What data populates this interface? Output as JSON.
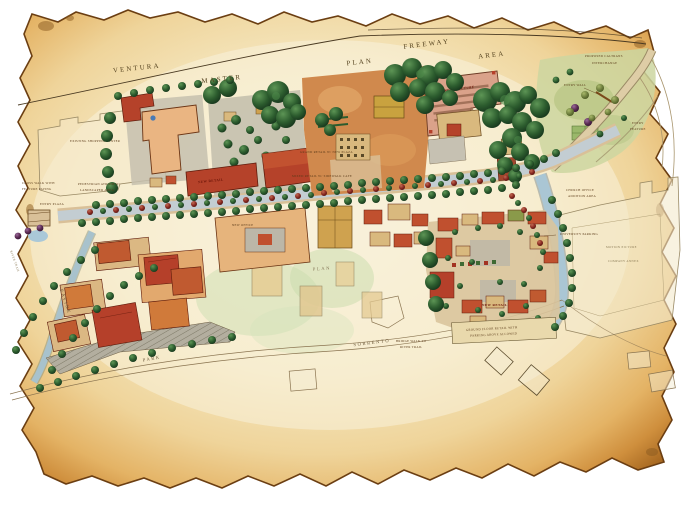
{
  "map": {
    "type": "hand-drawn master plan on parchment",
    "labels": {
      "ventura": "VENTURA",
      "master": "MASTER",
      "plan": "PLAN",
      "freeway": "FREEWAY",
      "area": "AREA",
      "parking_structure": "PARKING STRUCTURE",
      "new_retail_a": "NEW RETAIL",
      "new_retail_b": "NEW RETAIL",
      "grand_retail": "GRAND RETAIL W/ NEW PLAZA",
      "mixed_retail": "MIXED RETAIL W/ SIDEWALK CAFE",
      "new_office": "NEW OFFICE",
      "caltrans1": "PROPOSED CALTRANS",
      "caltrans2": "INTERCHANGE",
      "entry_wall": "ENTRY WALL",
      "entry1": "ENTRY",
      "entry2": "FEATURE",
      "church1": "CHURCH OFFICE",
      "church2": "ADDITION AREA",
      "university_parking": "UNIVERSITY PARKING",
      "motion1": "MOTION PICTURE",
      "motion2": "COMPANY ANNEX",
      "note1": "GROUND FLOOR RETAIL WITH",
      "note2": "PARKING ABOVE ALLOWED",
      "existing_center": "EXISTING SHOPPING CENTER",
      "crosswalk1": "CROSS WALK WITH",
      "crosswalk2": "FEATURE PAVING",
      "atrium1": "PEDESTRIAN ATRIUM W/",
      "atrium2": "LANDSCAPED AREA",
      "entry_plaza": "ENTRY PLAZA",
      "landscaped_area": "LANDSCAPED AREA",
      "ravine": "RAVINE",
      "park": "PARK",
      "sorrento": "SORRENTO",
      "plan_lower": "PLAN",
      "bridge1": "BRIDGE WALK TO",
      "bridge2": "RIVER TRAIL",
      "river_trail": "RIVER TRAIL"
    },
    "colors": {
      "parchment_center": "#f8efd8",
      "parchment_edge": "#a96a22",
      "tree_green": "#2c5c2e",
      "tree_red": "#8a2a22",
      "roof_red": "#b5422a",
      "building_peach": "#eab582",
      "parking_salmon": "#daa28a",
      "water_blue": "#aac6d4",
      "pavement": "#c3cdd2"
    }
  }
}
